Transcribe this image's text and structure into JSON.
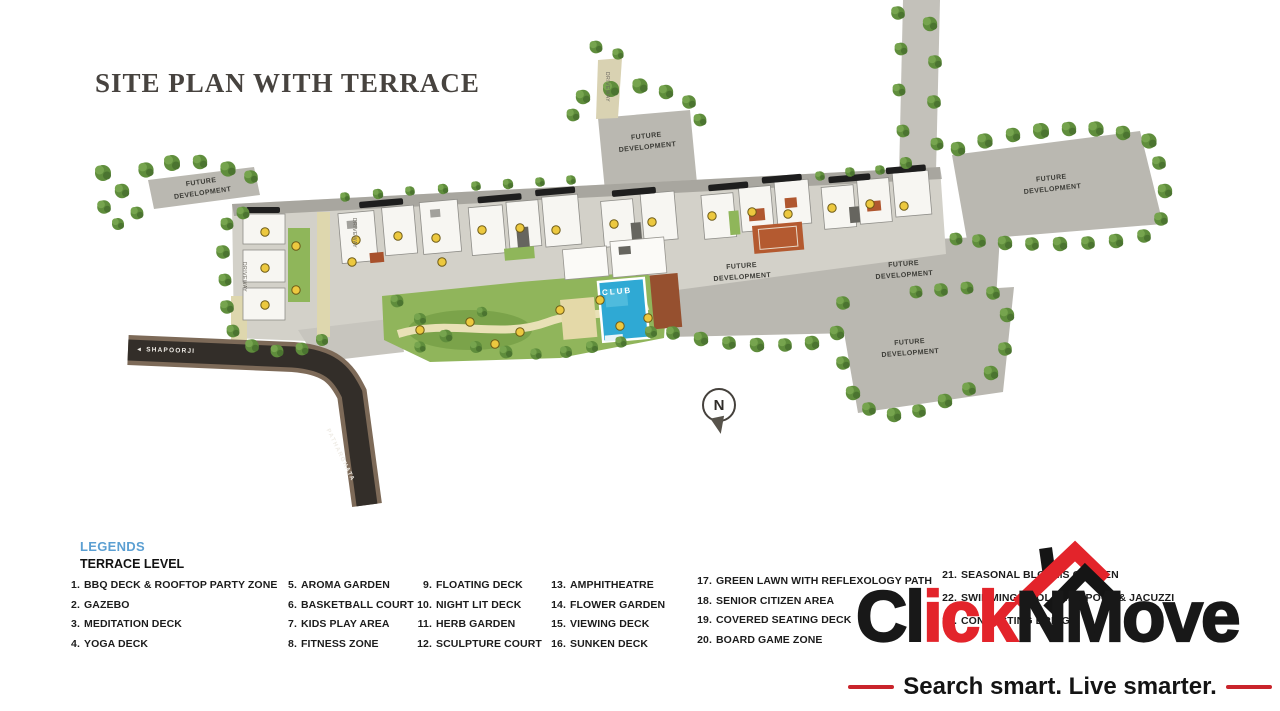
{
  "page": {
    "title": "SITE PLAN WITH TERRACE"
  },
  "plan": {
    "future_development": "FUTURE DEVELOPMENT",
    "club": "CLUB",
    "road_name_main": "SHAPOORJI",
    "road_name_side": "PATHARGHATA",
    "driveway": "DRIVEWAY",
    "compass_n": "N"
  },
  "legends": {
    "heading": "LEGENDS",
    "subheading": "TERRACE LEVEL",
    "items": [
      {
        "num": "1.",
        "label": "BBQ DECK & ROOFTOP PARTY ZONE"
      },
      {
        "num": "2.",
        "label": "GAZEBO"
      },
      {
        "num": "3.",
        "label": "MEDITATION DECK"
      },
      {
        "num": "4.",
        "label": "YOGA DECK"
      },
      {
        "num": "5.",
        "label": "AROMA GARDEN"
      },
      {
        "num": "6.",
        "label": "BASKETBALL COURT"
      },
      {
        "num": "7.",
        "label": "KIDS PLAY AREA"
      },
      {
        "num": "8.",
        "label": "FITNESS ZONE"
      },
      {
        "num": "9.",
        "label": "FLOATING DECK"
      },
      {
        "num": "10.",
        "label": "NIGHT LIT DECK"
      },
      {
        "num": "11.",
        "label": "HERB GARDEN"
      },
      {
        "num": "12.",
        "label": "SCULPTURE COURT"
      },
      {
        "num": "13.",
        "label": "AMPHITHEATRE"
      },
      {
        "num": "14.",
        "label": "FLOWER GARDEN"
      },
      {
        "num": "15.",
        "label": "VIEWING DECK"
      },
      {
        "num": "16.",
        "label": "SUNKEN DECK"
      },
      {
        "num": "17.",
        "label": "GREEN LAWN WITH REFLEXOLOGY PATH"
      },
      {
        "num": "18.",
        "label": "SENIOR CITIZEN AREA"
      },
      {
        "num": "19.",
        "label": "COVERED SEATING DECK"
      },
      {
        "num": "20.",
        "label": "BOARD GAME ZONE"
      },
      {
        "num": "21.",
        "label": "SEASONAL BLOOMS GARDEN"
      },
      {
        "num": "22.",
        "label": "SWIMMING POOL, KIDS POOL & JACUZZI"
      },
      {
        "num": "23.",
        "label": "CONNECTING BRIDGE"
      }
    ]
  },
  "logo": {
    "part_black_1": "Cl",
    "part_red": "ick",
    "part_black_2": "NMove",
    "tagline": "Search smart. Live smarter.",
    "red": "#E3242B",
    "black": "#181818"
  },
  "colors": {
    "legend_heading_blue": "#5B9FD2",
    "future_dev_gray": "#BAB8B1",
    "tree_green": "#5F8D3C",
    "pool_blue": "#2FA9D4",
    "road_dark": "#332E29",
    "title_gray": "#47433F"
  }
}
